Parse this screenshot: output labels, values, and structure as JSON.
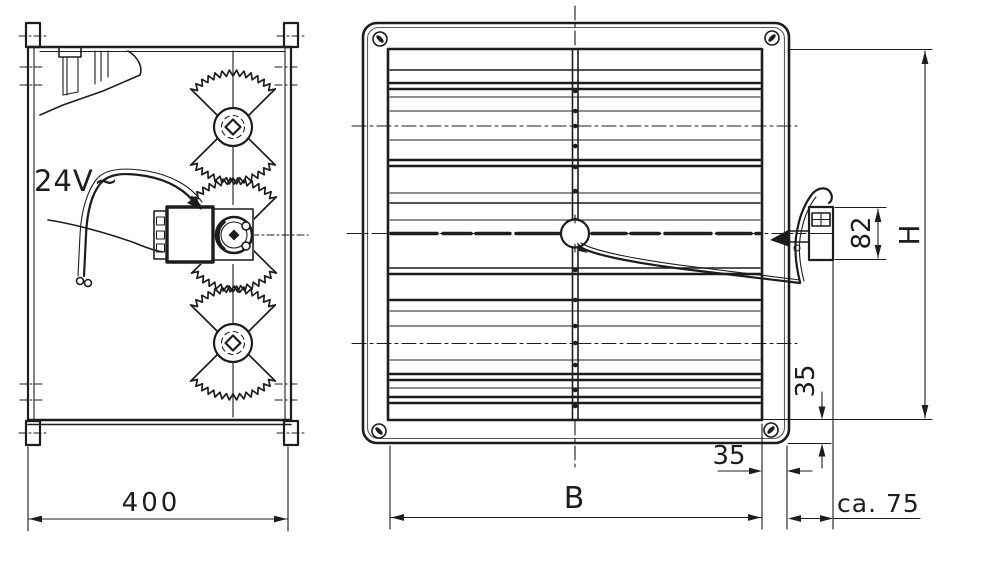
{
  "colors": {
    "ink": "#1d1d1d",
    "paper": "#ffffff",
    "faint_line": "#5a5a5a"
  },
  "side_view": {
    "voltage_label": "24V~",
    "depth_dim": "400"
  },
  "front_view": {
    "width_dim": "B",
    "height_dim": "H",
    "actuator_height_dim": "82",
    "flange_bottom_dim": "35",
    "flange_side_dim": "35",
    "actuator_depth_dim": "ca. 75"
  }
}
